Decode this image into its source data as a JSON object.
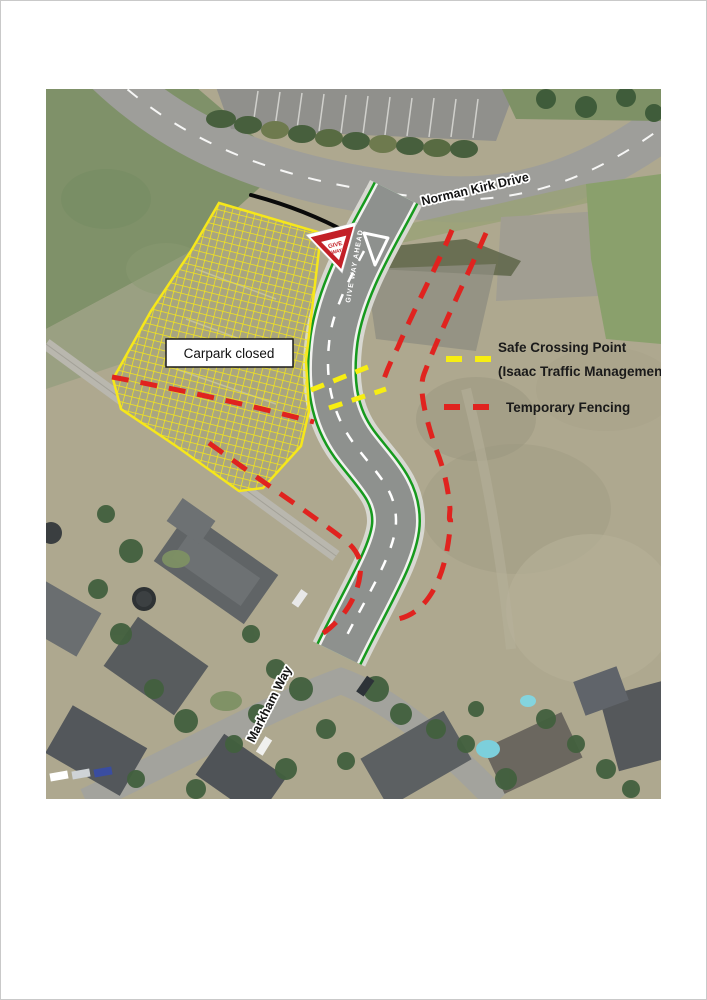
{
  "map": {
    "street_labels": {
      "top_road": "Norman Kirk Drive",
      "bottom_road": "Markham Way"
    },
    "carpark": {
      "label": "Carpark closed"
    },
    "give_way_sign": {
      "line1": "GIVE",
      "line2": "WAY"
    },
    "road_marking": {
      "text": "GIVE WAY AHEAD"
    },
    "legend": {
      "safe_crossing": {
        "line1": "Safe Crossing Point",
        "line2": "(Isaac Traffic Management)",
        "color": "#f7ee12"
      },
      "temporary_fencing": {
        "label": "Temporary Fencing",
        "color": "#e0231f"
      }
    },
    "colors": {
      "new_road_edge_green": "#169a1e",
      "carpark_hatch_yellow": "#f6e71a",
      "fencing_red": "#e0231f",
      "crossing_yellow": "#f7ee12"
    }
  }
}
